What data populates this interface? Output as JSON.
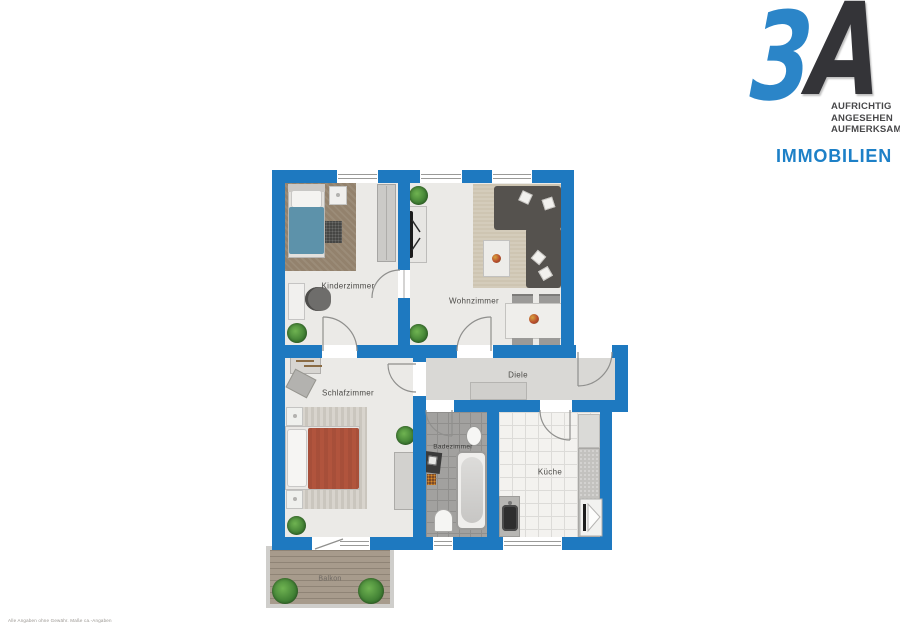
{
  "logo": {
    "numeral": "3",
    "letter": "A",
    "tagline": {
      "line1": "AUFRICHTIG",
      "line2": "ANGESEHEN",
      "line3": "AUFMERKSAM"
    },
    "brand": "IMMOBILIEN",
    "colors": {
      "blue": "#2b85c8",
      "dark": "#343438"
    }
  },
  "floorplan": {
    "colors": {
      "wall": "#1e79c0"
    },
    "rooms": {
      "kinderzimmer": {
        "label": "Kinderzimmer"
      },
      "wohnzimmer": {
        "label": "Wohnzimmer"
      },
      "schlafzimmer": {
        "label": "Schlafzimmer"
      },
      "diele": {
        "label": "Diele"
      },
      "badezimmer": {
        "label": "Badezimmer"
      },
      "kueche": {
        "label": "Küche"
      },
      "balkon": {
        "label": "Balkon"
      }
    }
  },
  "fine_print": "Alle Angaben ohne Gewähr. Maße ca.-Angaben"
}
